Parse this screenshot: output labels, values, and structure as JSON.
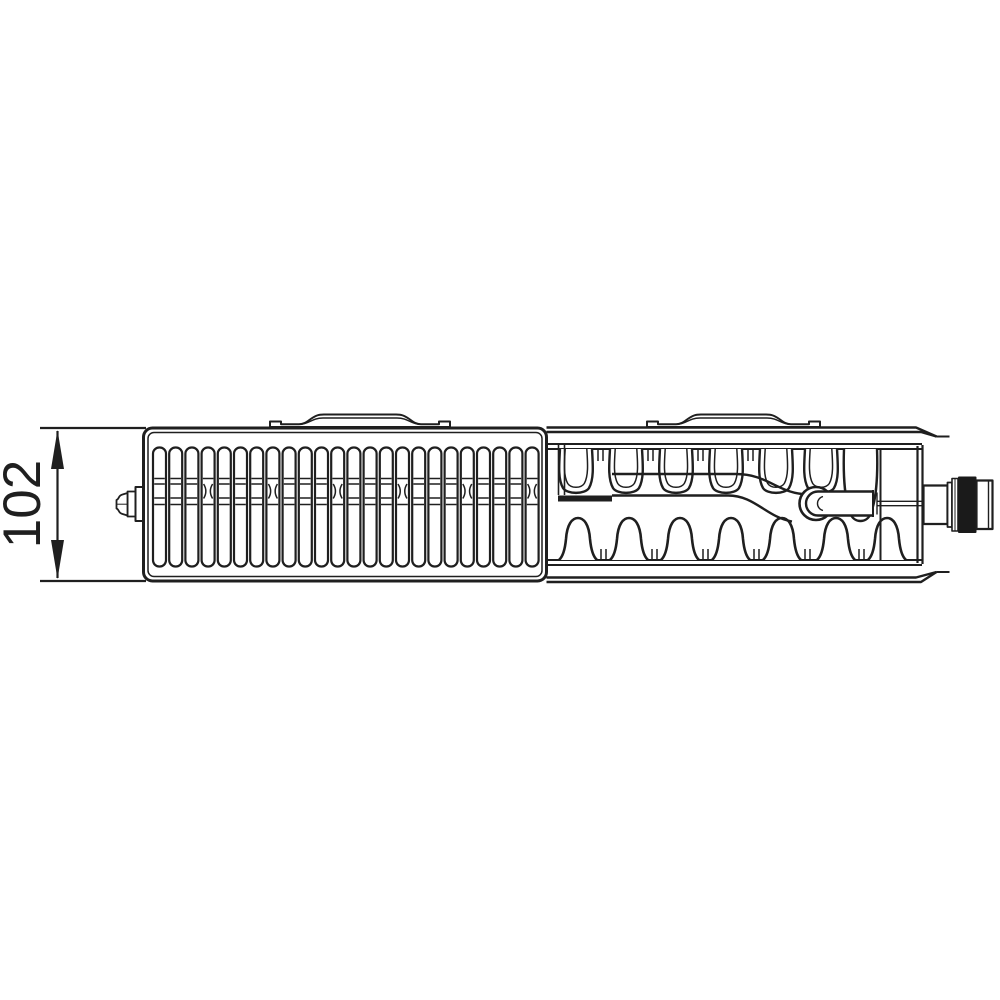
{
  "drawing": {
    "dimension_label": "102",
    "line_color": "#1f1f1f",
    "background_color": "#ffffff",
    "valve_fill_color": "#1a1a1a"
  }
}
